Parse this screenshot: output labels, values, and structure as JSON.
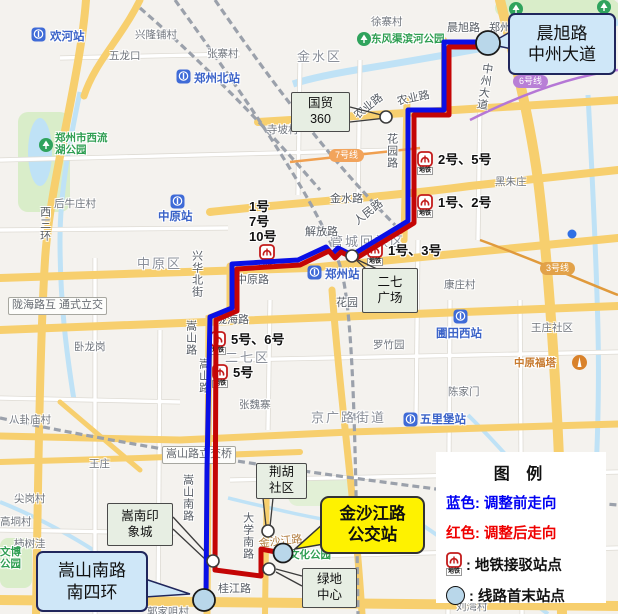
{
  "colors": {
    "route_blue": "#0a10e6",
    "route_red": "#c40505",
    "terminal_fill": "#b9d7ea",
    "metro_red": "#c31b1b",
    "station_blue": "#3f6bd7",
    "stop_stroke": "#3d3d3d"
  },
  "metro_tag": "地铁",
  "legend": {
    "title": "图  例",
    "rows": [
      {
        "text": "蓝色: 调整前走向",
        "color": "#0000f2"
      },
      {
        "text": "红色: 调整后走向",
        "color": "#ef0000"
      },
      {
        "icon": "metro",
        "text": ":  地铁接驳站点",
        "color": "#111"
      },
      {
        "icon": "terminal",
        "text": ":  线路首末站点",
        "color": "#111"
      }
    ]
  },
  "callouts": [
    {
      "id": "chenxu-zhongzhou",
      "lines": [
        "晨旭路",
        "中州大道"
      ],
      "x": 508,
      "y": 13,
      "w": 104,
      "h": 58,
      "style": "blue"
    },
    {
      "id": "songshan-nansihuan",
      "lines": [
        "嵩山南路",
        "南四环"
      ],
      "x": 36,
      "y": 551,
      "w": 108,
      "h": 57,
      "style": "blue"
    },
    {
      "id": "jinshajiang-stop",
      "lines": [
        "金沙江路",
        "公交站"
      ],
      "x": 320,
      "y": 496,
      "w": 101,
      "h": 54,
      "style": "yellow"
    },
    {
      "id": "guomao-360",
      "lines": [
        "国贸",
        "360"
      ],
      "x": 291,
      "y": 92,
      "w": 57,
      "h": 38,
      "style": "sage"
    },
    {
      "id": "erqi-square",
      "lines": [
        "二七",
        "广场"
      ],
      "x": 362,
      "y": 268,
      "w": 54,
      "h": 43,
      "style": "sage"
    },
    {
      "id": "songnan-mall",
      "lines": [
        "嵩南印",
        "象城"
      ],
      "x": 107,
      "y": 503,
      "w": 64,
      "h": 41,
      "style": "sage"
    },
    {
      "id": "jinghu-shequ",
      "lines": [
        "荆胡",
        "社区"
      ],
      "x": 256,
      "y": 463,
      "w": 49,
      "h": 34,
      "style": "sage"
    },
    {
      "id": "lvdi-center",
      "lines": [
        "绿地",
        "中心"
      ],
      "x": 302,
      "y": 568,
      "w": 53,
      "h": 38,
      "style": "sage"
    }
  ],
  "map": {
    "districts": [
      {
        "t": "金水区",
        "x": 297,
        "y": 50
      },
      {
        "t": "中原区",
        "x": 137,
        "y": 257
      },
      {
        "t": "二七区",
        "x": 225,
        "y": 351
      },
      {
        "t": "管城回族区",
        "x": 330,
        "y": 235
      },
      {
        "t": "京广路街道",
        "x": 311,
        "y": 411
      }
    ],
    "roads": [
      {
        "t": "晨旭路",
        "x": 447,
        "y": 22
      },
      {
        "t": "郑州",
        "x": 489,
        "y": 22
      },
      {
        "t": "农业路",
        "x": 396,
        "y": 96,
        "rot": -12
      },
      {
        "t": "农业路",
        "x": 352,
        "y": 112,
        "rot": -38
      },
      {
        "t": "花园路",
        "x": 385,
        "y": 133,
        "vert": 1
      },
      {
        "t": "金水路",
        "x": 330,
        "y": 193
      },
      {
        "t": "人民路",
        "x": 352,
        "y": 218,
        "rot": -38
      },
      {
        "t": "解放路",
        "x": 305,
        "y": 226
      },
      {
        "t": "中原路",
        "x": 236,
        "y": 274
      },
      {
        "t": "陇海路",
        "x": 216,
        "y": 314
      },
      {
        "t": "兴华北街",
        "x": 190,
        "y": 250,
        "vert": 1
      },
      {
        "t": "嵩山路",
        "x": 184,
        "y": 320,
        "vert": 1
      },
      {
        "t": "嵩山路",
        "x": 197,
        "y": 358,
        "vert": 1
      },
      {
        "t": "嵩山南路",
        "x": 181,
        "y": 474,
        "vert": 1
      },
      {
        "t": "大学南路",
        "x": 241,
        "y": 512,
        "vert": 1
      },
      {
        "t": "桂江路",
        "x": 218,
        "y": 583
      },
      {
        "t": "金沙江路",
        "x": 258,
        "y": 538,
        "rot": -6,
        "c": "#b07a3a"
      },
      {
        "t": "中州大道",
        "x": 481,
        "y": 62,
        "vert": 1,
        "rot": 8
      },
      {
        "t": "西三环",
        "x": 38,
        "y": 206,
        "vert": 1
      },
      {
        "t": "花园",
        "x": 336,
        "y": 297
      }
    ],
    "places": [
      {
        "t": "徐寨村",
        "x": 371,
        "y": 16
      },
      {
        "t": "兴隆铺村",
        "x": 135,
        "y": 29
      },
      {
        "t": "五龙口",
        "x": 109,
        "y": 50
      },
      {
        "t": "张寨村",
        "x": 207,
        "y": 48
      },
      {
        "t": "寺坡村",
        "x": 267,
        "y": 124
      },
      {
        "t": "黑朱庄",
        "x": 495,
        "y": 176
      },
      {
        "t": "后牛庄村",
        "x": 54,
        "y": 198
      },
      {
        "t": "康庄村",
        "x": 444,
        "y": 279
      },
      {
        "t": "王庄社区",
        "x": 531,
        "y": 322
      },
      {
        "t": "罗竹园",
        "x": 373,
        "y": 339
      },
      {
        "t": "陈家门",
        "x": 448,
        "y": 386
      },
      {
        "t": "张魏寨",
        "x": 239,
        "y": 399
      },
      {
        "t": "卧龙岗",
        "x": 74,
        "y": 341
      },
      {
        "t": "八卦庙村",
        "x": 9,
        "y": 414
      },
      {
        "t": "王庄",
        "x": 89,
        "y": 458
      },
      {
        "t": "尖岗村",
        "x": 14,
        "y": 493
      },
      {
        "t": "高垌村",
        "x": 0,
        "y": 516
      },
      {
        "t": "柿树洼",
        "x": 14,
        "y": 538
      },
      {
        "t": "刘湾村",
        "x": 456,
        "y": 601
      },
      {
        "t": "郭家咀村",
        "x": 147,
        "y": 606
      }
    ],
    "greens": [
      {
        "t": "东风渠滨河公园",
        "x": 371,
        "y": 33
      },
      {
        "t": "郑州市西流\n湖公园",
        "x": 55,
        "y": 132
      },
      {
        "t": "文博\n公园",
        "x": 0,
        "y": 546
      },
      {
        "t": "文化公园",
        "x": 289,
        "y": 549
      }
    ],
    "park_icons": [
      {
        "x": 356,
        "y": 32
      },
      {
        "x": 38,
        "y": 138
      },
      {
        "x": 508,
        "y": 2
      },
      {
        "x": 596,
        "y": 0
      }
    ],
    "tower": {
      "t": "中原福塔",
      "x": 514,
      "y": 357,
      "ix": 571,
      "iy": 355
    },
    "stations": [
      {
        "t": "欢河站",
        "ix": 30,
        "iy": 27,
        "lx": 50,
        "ly": 31
      },
      {
        "t": "郑州北站",
        "ix": 175,
        "iy": 69,
        "lx": 194,
        "ly": 73
      },
      {
        "t": "中原站",
        "ix": 169,
        "iy": 194,
        "lx": 158,
        "ly": 211
      },
      {
        "t": "郑州站",
        "ix": 306,
        "iy": 265,
        "lx": 325,
        "ly": 269
      },
      {
        "t": "圃田西站",
        "ix": 452,
        "iy": 309,
        "lx": 436,
        "ly": 328
      },
      {
        "t": "五里堡站",
        "ix": 402,
        "iy": 412,
        "lx": 420,
        "ly": 414
      }
    ],
    "interchanges": [
      {
        "t": "2号、5号",
        "ix": 417,
        "iy": 151,
        "lx": 438,
        "ly": 153
      },
      {
        "t": "1号、2号",
        "ix": 417,
        "iy": 194,
        "lx": 438,
        "ly": 196
      },
      {
        "t": "1号、3号",
        "ix": 367,
        "iy": 242,
        "lx": 388,
        "ly": 244
      },
      {
        "t": "1号\n7号\n10号",
        "ix": 259,
        "iy": 244,
        "lx": 249,
        "ly": 200
      },
      {
        "t": "5号、6号",
        "ix": 210,
        "iy": 331,
        "lx": 231,
        "ly": 333
      },
      {
        "t": "5号",
        "ix": 212,
        "iy": 364,
        "lx": 233,
        "ly": 366
      }
    ],
    "line_badges": [
      {
        "t": "6号线",
        "x": 513,
        "y": 75,
        "c": "#b87fd6"
      },
      {
        "t": "7号线",
        "x": 329,
        "y": 149,
        "c": "#f2a45c"
      },
      {
        "t": "3号线",
        "x": 540,
        "y": 262,
        "c": "#e2a249"
      }
    ],
    "plates": [
      {
        "t": "陇海路互\n通式立交",
        "x": 8,
        "y": 297
      },
      {
        "t": "嵩山路立交桥",
        "x": 162,
        "y": 446
      }
    ],
    "route": {
      "blue": [
        [
          488,
          42
        ],
        [
          444,
          42
        ],
        [
          444,
          110
        ],
        [
          408,
          110
        ],
        [
          408,
          221
        ],
        [
          352,
          255
        ],
        [
          338,
          248
        ],
        [
          332,
          254
        ],
        [
          326,
          247
        ],
        [
          298,
          260
        ],
        [
          232,
          264
        ],
        [
          232,
          308
        ],
        [
          210,
          317
        ],
        [
          207,
          470
        ],
        [
          206,
          598
        ]
      ],
      "red": [
        [
          488,
          47
        ],
        [
          449,
          47
        ],
        [
          449,
          115
        ],
        [
          414,
          115
        ],
        [
          414,
          223
        ],
        [
          355,
          259
        ],
        [
          341,
          252
        ],
        [
          335,
          258
        ],
        [
          329,
          251
        ],
        [
          300,
          265
        ],
        [
          237,
          269
        ],
        [
          237,
          311
        ],
        [
          216,
          320
        ],
        [
          215,
          570
        ],
        [
          261,
          576
        ],
        [
          261,
          549
        ],
        [
          281,
          553
        ]
      ],
      "stops": [
        [
          386,
          117
        ],
        [
          352,
          256
        ],
        [
          268,
          531
        ],
        [
          213,
          561
        ],
        [
          269,
          569
        ]
      ],
      "terminals": [
        [
          488,
          43,
          12
        ],
        [
          204,
          600,
          11
        ],
        [
          283,
          553,
          9.5
        ]
      ],
      "pointers": [
        [
          350,
          107,
          385,
          116
        ],
        [
          350,
          122,
          386,
          118
        ],
        [
          366,
          269,
          354,
          258
        ],
        [
          377,
          269,
          356,
          259
        ],
        [
          173,
          517,
          209,
          556
        ],
        [
          173,
          529,
          206,
          560
        ],
        [
          263,
          498,
          266,
          526
        ],
        [
          273,
          498,
          270,
          527
        ],
        [
          302,
          576,
          276,
          569
        ],
        [
          302,
          586,
          276,
          572
        ]
      ],
      "tails": [
        {
          "pts": "512,31 489,44 512,49",
          "fill": "#cfe7f8",
          "stroke": "#20265c"
        },
        {
          "pts": "145,579 190,594 145,597",
          "fill": "#cfe7f8",
          "stroke": "#20265c"
        },
        {
          "pts": "324,523 295,549 324,544",
          "fill": "#fef200",
          "stroke": "#333333"
        }
      ]
    }
  }
}
